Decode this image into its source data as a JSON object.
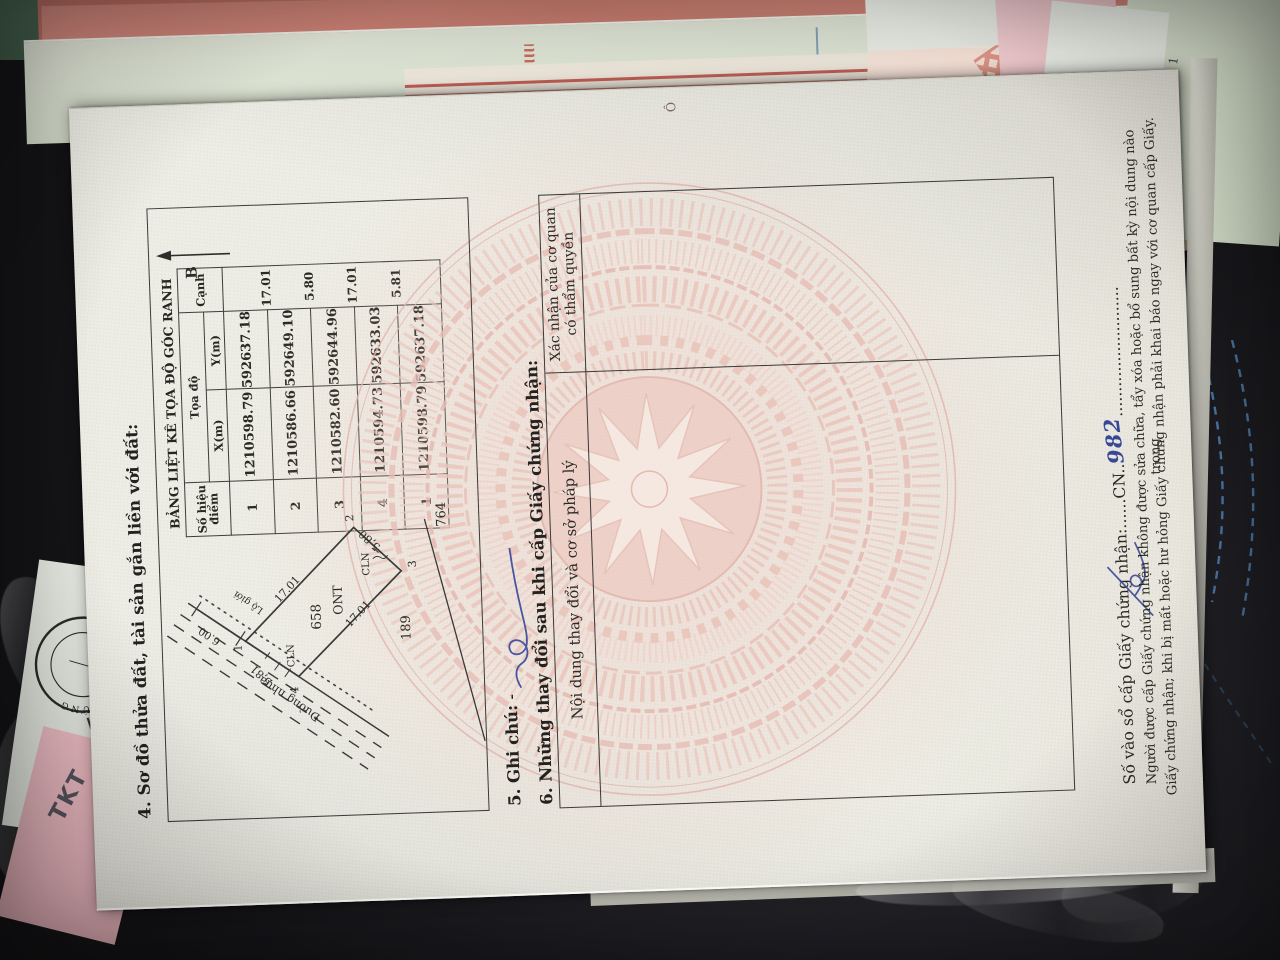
{
  "photo": {
    "stamp_seal_text": "PHÒNG CÔNG CHỨNG",
    "pink_note_text": "TKT",
    "underpage_page_number": "1",
    "colors": {
      "felt_green": "#3f5b49",
      "leather_black": "#17171a",
      "stitch_blue": "#4f83b8",
      "page_cream": "#efeee6",
      "watermark_pink": "#eac2b9",
      "pen_blue": "#35479b",
      "table_border": "#3a3a38"
    }
  },
  "certificate": {
    "section4": {
      "heading": "4. Sơ đồ thửa đất, tài sản gắn liền với đất:",
      "north_label": "B",
      "coord_table": {
        "title": "BẢNG LIỆT KÊ TỌA ĐỘ GÓC RANH",
        "col_point_line1": "Số hiệu",
        "col_point_line2": "điểm",
        "col_group": "Tọa độ",
        "col_x": "X(m)",
        "col_y": "Y(m)",
        "col_edge": "Cạnh",
        "rows": [
          {
            "point": "1",
            "x": "1210598.79",
            "y": "592637.18",
            "edge": "17.01"
          },
          {
            "point": "2",
            "x": "1210586.66",
            "y": "592649.10",
            "edge": "5.80"
          },
          {
            "point": "3",
            "x": "1210582.60",
            "y": "592644.96",
            "edge": "17.01"
          },
          {
            "point": "4",
            "x": "1210594.73",
            "y": "592633.03",
            "edge": "5.81"
          },
          {
            "point": "1",
            "x": "1210598.79",
            "y": "592637.18",
            "edge": ""
          }
        ]
      },
      "plot": {
        "parcel_number": "658",
        "land_use_code": "ONT",
        "vertex_1": "1",
        "vertex_2": "2",
        "vertex_3": "3",
        "vertex_4": "4",
        "edge_12": "17.01",
        "edge_23": "5,80",
        "edge_34": "17.01",
        "edge_41": "5,81",
        "adjacent_parcel_right": "764",
        "adjacent_parcel_below": "189",
        "cln_label_1": "CLN",
        "cln_label_2": "CLN",
        "road_label": "Đường nhựa",
        "road_width": "6.00",
        "boundary_label": "Lộ giới"
      }
    },
    "section5": {
      "heading": "5. Ghi chú:",
      "dash": "-"
    },
    "section6": {
      "heading": "6. Những thay đổi sau khi cấp Giấy chứng nhận:",
      "col_content": "Nội dung thay đổi và cơ sở pháp lý",
      "col_confirm_line1": "Xác nhận của cơ quan",
      "col_confirm_line2": "có thẩm quyền"
    },
    "footer": {
      "serial_label": "Số vào sổ cấp Giấy chứng nhận:",
      "serial_dots1": "......",
      "serial_prefix": "CN",
      "serial_dots_mid": "..",
      "serial_handwritten": "982",
      "serial_dots2": "..........................",
      "note_line1": "Người được cấp Giấy chứng nhận không được sửa chữa, tẩy xóa hoặc bổ sung bất kỳ nội dung nào trong",
      "note_line2": "Giấy chứng nhận; khi bị mất hoặc hư hỏng Giấy chứng nhận phải khai báo ngay với cơ quan cấp Giấy."
    },
    "margin_mark": "Ô"
  }
}
